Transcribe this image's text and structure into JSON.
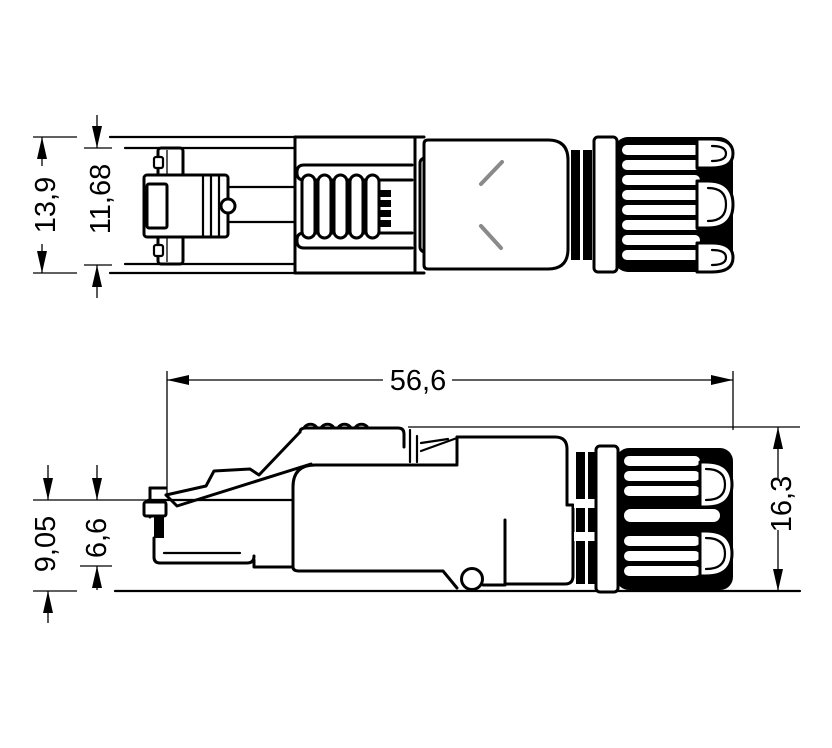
{
  "figure": {
    "kind": "technical-dimension-drawing",
    "subject": "field-assembly RJ45 connector plug shown in two orthographic line-art views",
    "background_color": "#ffffff",
    "line_color": "#000000",
    "chamfer_mark_color": "#8a8a8a"
  },
  "views": {
    "top_view": {
      "name": "top view",
      "dimensions": {
        "overall_width": {
          "label": "13,9"
        },
        "body_width": {
          "label": "11,68"
        }
      }
    },
    "side_view": {
      "name": "side view",
      "dimensions": {
        "overall_length": {
          "label": "56,6"
        },
        "base_height": {
          "label": "9,05"
        },
        "nose_height": {
          "label": "6,6"
        },
        "overall_height": {
          "label": "16,3"
        }
      }
    }
  }
}
